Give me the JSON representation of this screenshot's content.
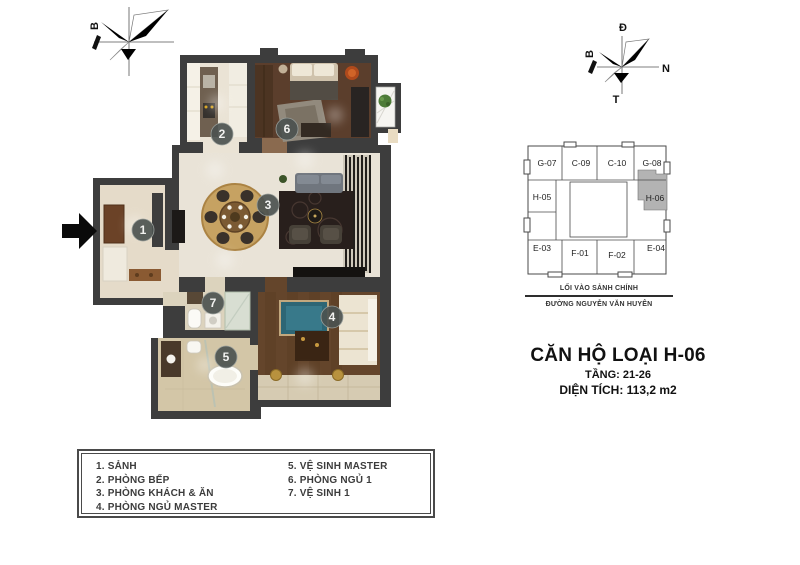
{
  "colors": {
    "wall": "#3d3d3d",
    "number_badge": "#4c5250",
    "keyplan_highlight": "#b3b3b3",
    "entry_arrow": "#000000"
  },
  "compass_left": {
    "north_label": "B"
  },
  "compass_right": {
    "top": "Đ",
    "left": "B",
    "right": "N",
    "bottom": "T"
  },
  "floor_plan": {
    "rooms": [
      {
        "number": "1",
        "name": "SẢNH"
      },
      {
        "number": "2",
        "name": "PHÒNG BẾP"
      },
      {
        "number": "3",
        "name": "PHÒNG KHÁCH & ĂN"
      },
      {
        "number": "4",
        "name": "PHÒNG NGỦ MASTER"
      },
      {
        "number": "5",
        "name": "VỆ SINH MASTER"
      },
      {
        "number": "6",
        "name": "PHÒNG NGỦ 1"
      },
      {
        "number": "7",
        "name": "VỆ SINH 1"
      }
    ]
  },
  "key_plan": {
    "units": [
      {
        "id": "G-07",
        "highlighted": false
      },
      {
        "id": "C-09",
        "highlighted": false
      },
      {
        "id": "C-10",
        "highlighted": false
      },
      {
        "id": "G-08",
        "highlighted": false
      },
      {
        "id": "H-05",
        "highlighted": false
      },
      {
        "id": "H-06",
        "highlighted": true
      },
      {
        "id": "E-03",
        "highlighted": false
      },
      {
        "id": "F-01",
        "highlighted": false
      },
      {
        "id": "F-02",
        "highlighted": false
      },
      {
        "id": "E-04",
        "highlighted": false
      }
    ],
    "entrance_label": "LỐI VÀO SẢNH CHÍNH",
    "street_label": "ĐƯỜNG NGUYỄN VĂN HUYÊN"
  },
  "title_block": {
    "title": "CĂN HỘ LOẠI H-06",
    "floors": "TẦNG: 21-26",
    "area": "DIỆN TÍCH: 113,2 m2"
  },
  "legend": {
    "left_column": [
      "1. SẢNH",
      "2. PHÒNG BẾP",
      "3. PHÒNG KHÁCH & ĂN",
      "4. PHÒNG NGỦ MASTER"
    ],
    "right_column": [
      "5. VỆ SINH MASTER",
      "6. PHÒNG NGỦ 1",
      "7. VỆ SINH 1"
    ]
  }
}
